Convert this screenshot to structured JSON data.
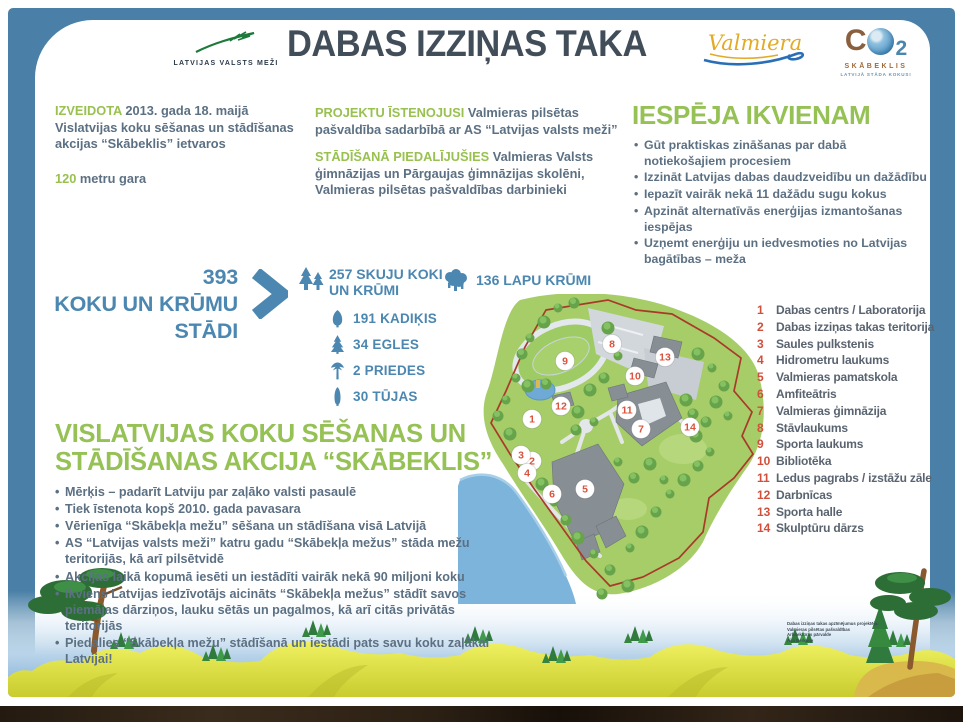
{
  "header": {
    "lvm_logo": "LATVIJAS VALSTS MEŽI",
    "title": "DABAS IZZIŅAS TAKA",
    "valmiera_logo": "Valmiera",
    "co2_c": "C",
    "co2_2": "2",
    "co2_label": "SKĀBEKLIS",
    "co2_sub": "LATVIJĀ STĀDA KOKUS!"
  },
  "facts": {
    "created_label": "IZVEIDOTA",
    "created_text": "2013. gada 18. maijā Vislatvijas koku sēšanas un stādīšanas akcijas “Skābeklis” ietvaros",
    "length_value": "120",
    "length_text": "metru gara",
    "implemented_label": "PROJEKTU ĪSTENOJUSI",
    "implemented_text": "Valmieras pilsētas pašvaldība sadarbībā ar AS “Latvijas valsts meži”",
    "planting_label": "STĀDĪŠANĀ PIEDALĪJUŠIES",
    "planting_text": "Valmieras Valsts ģimnāzijas un Pārgaujas ģimnāzijas skolēni, Valmieras pilsētas pašvaldības darbinieki"
  },
  "opportunities": {
    "heading": "IESPĒJA IKVIENAM",
    "bullets": [
      "Gūt praktiskas zināšanas par dabā notiekošajiem procesiem",
      "Izzināt Latvijas dabas daudzveidību un dažādību",
      "Iepazīt vairāk nekā 11 dažādu sugu kokus",
      "Apzināt alternatīvās enerģijas izmantošanas iespējas",
      "Uzņemt enerģiju un iedvesmoties no Latvijas bagātības – meža"
    ]
  },
  "stats": {
    "total_number": "393",
    "total_label_line1": "KOKU UN KRŪMU",
    "total_label_line2": "STĀDI",
    "conifer_line1": "257 SKUJU KOKI",
    "conifer_line2": "UN KRŪMI",
    "leafy_count": "136 LAPU KRŪMI",
    "breakdown": [
      {
        "label": "191 KADIĶIS",
        "icon": "juniper-icon"
      },
      {
        "label": "34 EGLES",
        "icon": "spruce-icon"
      },
      {
        "label": "2 PRIEDES",
        "icon": "pine-icon"
      },
      {
        "label": "30 TŪJAS",
        "icon": "thuja-icon"
      }
    ]
  },
  "campaign": {
    "heading": "VISLATVIJAS KOKU SĒŠANAS UN STĀDĪŠANAS AKCIJA “SKĀBEKLIS”",
    "bullets": [
      "Mērķis – padarīt Latviju par zaļāko valsti pasaulē",
      "Tiek īstenota kopš 2010. gada pavasara",
      "Vērienīga “Skābekļa mežu” sēšana un stādīšana visā Latvijā",
      "AS “Latvijas valsts meži” katru gadu “Skābekļa mežus” stāda mežu teritorijās, kā arī pilsētvidē",
      "Akcijas laikā kopumā iesēti un iestādīti vairāk nekā 90 miljoni koku",
      "Ikviens Latvijas iedzīvotājs aicināts “Skābekļa mežus” stādīt savos piemājas dārziņos, lauku sētās un pagalmos, kā arī citās privātās teritorijās",
      "Piedalies “Skābekļa mežu” stādīšanā un iestādi pats savu koku zaļākai Latvijai!"
    ]
  },
  "map": {
    "markers": [
      {
        "n": "1",
        "x": 74,
        "y": 125
      },
      {
        "n": "2",
        "x": 74,
        "y": 167
      },
      {
        "n": "3",
        "x": 63,
        "y": 161
      },
      {
        "n": "4",
        "x": 69,
        "y": 179
      },
      {
        "n": "5",
        "x": 127,
        "y": 195
      },
      {
        "n": "6",
        "x": 94,
        "y": 200
      },
      {
        "n": "7",
        "x": 183,
        "y": 135
      },
      {
        "n": "8",
        "x": 154,
        "y": 50
      },
      {
        "n": "9",
        "x": 107,
        "y": 67
      },
      {
        "n": "10",
        "x": 177,
        "y": 82
      },
      {
        "n": "11",
        "x": 169,
        "y": 116
      },
      {
        "n": "12",
        "x": 103,
        "y": 112
      },
      {
        "n": "13",
        "x": 207,
        "y": 63
      },
      {
        "n": "14",
        "x": 232,
        "y": 133
      }
    ]
  },
  "legend": {
    "items": [
      {
        "n": "1",
        "label": "Dabas centrs / Laboratorija"
      },
      {
        "n": "2",
        "label": "Dabas izziņas takas teritorija"
      },
      {
        "n": "3",
        "label": "Saules pulkstenis"
      },
      {
        "n": "4",
        "label": "Hidrometru laukums"
      },
      {
        "n": "5",
        "label": "Valmieras pamatskola"
      },
      {
        "n": "6",
        "label": "Amfiteātris"
      },
      {
        "n": "7",
        "label": "Valmieras ģimnāzija"
      },
      {
        "n": "8",
        "label": "Stāvlaukums"
      },
      {
        "n": "9",
        "label": "Sporta laukums"
      },
      {
        "n": "10",
        "label": "Bibliotēka"
      },
      {
        "n": "11",
        "label": "Ledus pagrabs / izstāžu zāle"
      },
      {
        "n": "12",
        "label": "Darbnīcas"
      },
      {
        "n": "13",
        "label": "Sporta halle"
      },
      {
        "n": "14",
        "label": "Skulptūru dārzs"
      }
    ]
  },
  "credits": {
    "lines": [
      "Dabas izziņas takas apzīmējumus projektēja:",
      "Valmieras pilsētas pašvaldības",
      "Arhitektūras pārvalde",
      "Aija Berkone"
    ]
  },
  "colors": {
    "frame_blue": "#4a80a7",
    "heading_green": "#95c155",
    "body_text": "#5c7083",
    "stat_blue": "#4b87b0",
    "legend_red": "#d0503c",
    "title_dark": "#414d59"
  }
}
